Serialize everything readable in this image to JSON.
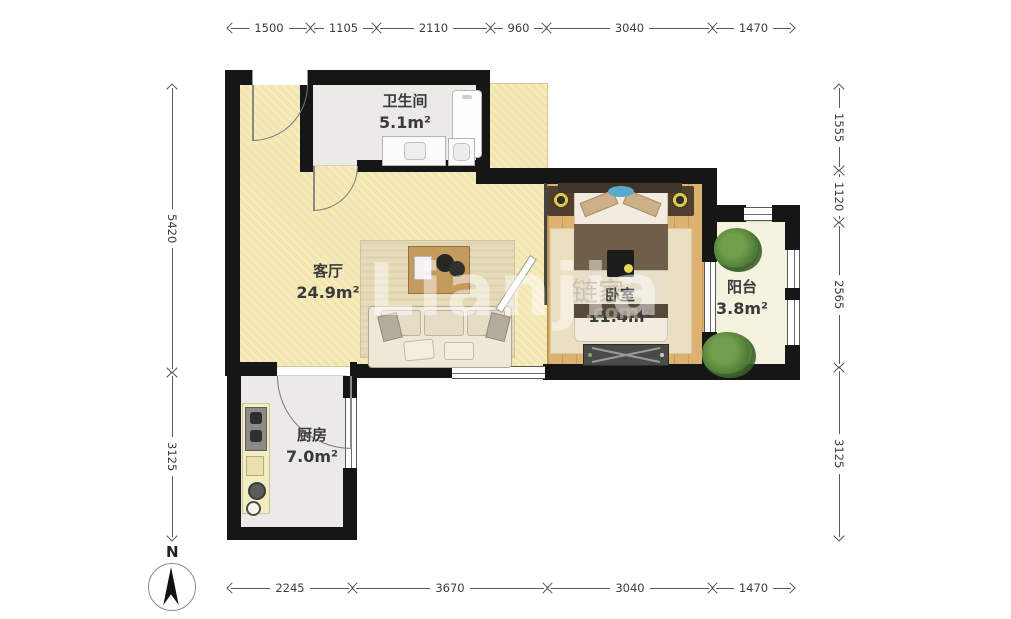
{
  "compass": {
    "label": "N"
  },
  "watermark": {
    "brand": "Lianjia",
    "brand_cn": "链家",
    "suffix": ".com"
  },
  "rooms": {
    "bathroom": {
      "name": "卫生间",
      "area": "5.1m²"
    },
    "living": {
      "name": "客厅",
      "area": "24.9m²"
    },
    "bedroom": {
      "name": "卧室",
      "area": "11.4m²"
    },
    "balcony": {
      "name": "阳台",
      "area": "3.8m²"
    },
    "kitchen": {
      "name": "厨房",
      "area": "7.0m²"
    }
  },
  "dimensions": {
    "top": [
      "1500",
      "1105",
      "2110",
      "960",
      "3040",
      "1470"
    ],
    "bottom": [
      "2245",
      "3670",
      "3040",
      "1470"
    ],
    "left": [
      "5420",
      "3125"
    ],
    "right": [
      "1555",
      "1120",
      "2565",
      "3125"
    ]
  },
  "colors": {
    "wall": "#161616",
    "living_floor": "#f2e5ae",
    "bedroom_floor": "#ddb270",
    "bathroom_floor": "#ebeae6",
    "balcony_floor": "#f6f2e0",
    "dimension_text": "#3c3c3c"
  }
}
